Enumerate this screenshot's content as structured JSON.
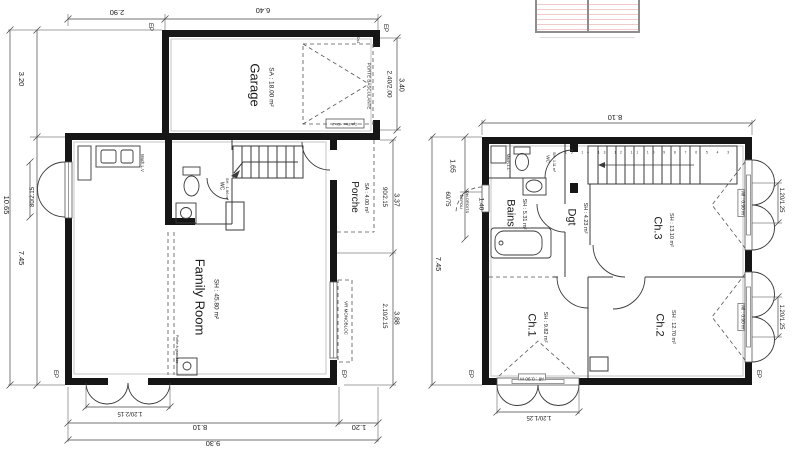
{
  "sheet": {
    "background": "#ffffff",
    "wall_color": "#161616",
    "thin_line_color": "#3a3a3a",
    "light_line_color": "#c6c6c6",
    "hatch_pink": "#f2c9c9"
  },
  "ground_floor": {
    "rooms": {
      "garage": {
        "name": "Garage",
        "area": "SA : 18.00 m²"
      },
      "family_room": {
        "name": "Family Room",
        "area": "SH : 45.80 m²"
      },
      "porch": {
        "name": "Porche",
        "area": "SA : 4.00 m²"
      },
      "wc": {
        "name": "WC",
        "area": "SH : 1.66 m²"
      }
    },
    "annotations": {
      "mach_lv": "Mach.L.V",
      "vr_monobloc": "VR MONOBLOC",
      "porte_basculante": "PORTE BASCULANTE",
      "poele": "Poêle à granulés",
      "elec": "Cpt.Elec.+DisJ",
      "dsj": "DsJ",
      "ep": "EP"
    },
    "dimensions": {
      "top": [
        "2.90",
        "6.40"
      ],
      "left": [
        "3.20",
        "7.45",
        "10.65"
      ],
      "right": [
        "90/2.15",
        "3.37",
        "2.10/2.15",
        "3.88"
      ],
      "bottom": [
        "1.20/2.15",
        "8.10",
        "1.20",
        "9.30"
      ],
      "left_door": "80/2.15",
      "garage_door": [
        "2.40/2.00",
        "3.40"
      ]
    }
  },
  "first_floor": {
    "rooms": {
      "bains": {
        "name": "Bains",
        "area": "SH : 5.31 m²"
      },
      "wc": {
        "name": "WC",
        "area": "SH : 1.11 m²"
      },
      "dgt": {
        "name": "Dgt",
        "area": "SH : 4.23 m²"
      },
      "ch1": {
        "name": "Ch.1",
        "area": "SH : 9.82 m²"
      },
      "ch2": {
        "name": "Ch.2",
        "area": "SH : 12.70 m²"
      },
      "ch3": {
        "name": "Ch.3",
        "area": "SH : 13.10 m²"
      }
    },
    "annotations": {
      "mach_ll": "Mach.L.L",
      "depoli": "DEPOLI",
      "dbl_droits": "Dbl.DROITS",
      "allege": "All : 0.90 m",
      "ep": "EP",
      "stair_numbers": "15 14 13 12 11 10 9 8 7 6 5 4 3"
    },
    "dimensions": {
      "top": [
        "8.10"
      ],
      "left": [
        "1.65",
        "60/75",
        "1.40",
        "7.45"
      ],
      "right": [
        "1.20/1.25",
        "1.20/1.25"
      ],
      "bottom": [
        "1.20/1.25"
      ]
    }
  }
}
